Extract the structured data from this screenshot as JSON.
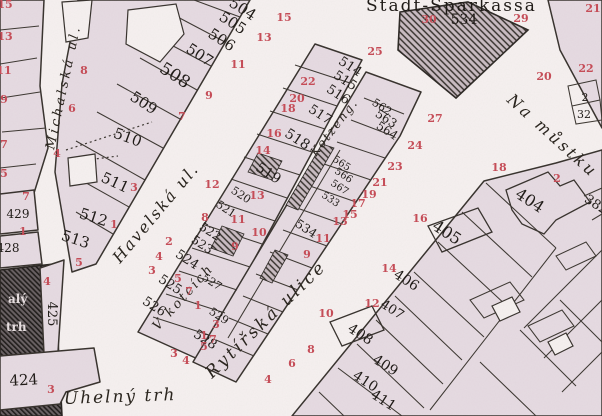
{
  "map": {
    "colors": {
      "paper": "#f6f1f0",
      "block_fill": "#e6dbe2",
      "line": "#35302b",
      "house_number_red": "#c64a55",
      "plot_number_black": "#1b1713"
    },
    "street_labels": [
      {
        "text": "Michalská ul.",
        "x": 54,
        "y": 150,
        "rot": -78,
        "size": 13,
        "ls": 3
      },
      {
        "text": "Havelská ul.",
        "x": 120,
        "y": 264,
        "rot": -50,
        "size": 16,
        "ls": 2
      },
      {
        "text": "Kotzeng.",
        "x": 316,
        "y": 157,
        "rot": -52,
        "size": 12,
        "ls": 2
      },
      {
        "text": "V kotcích",
        "x": 158,
        "y": 331,
        "rot": -48,
        "size": 13,
        "ls": 2.5
      },
      {
        "text": "Rytířská ulice",
        "x": 212,
        "y": 379,
        "rot": -44,
        "size": 17,
        "ls": 3
      },
      {
        "text": "Uhelný trh",
        "x": 64,
        "y": 404,
        "rot": -2,
        "size": 17,
        "ls": 2
      },
      {
        "text": "Na můstku",
        "x": 506,
        "y": 101,
        "rot": 42,
        "size": 16,
        "ls": 3
      }
    ],
    "building_labels": [
      {
        "text": "Stadt-Sparkassa",
        "x": 366,
        "y": 11,
        "rot": 0,
        "size": 17,
        "ls": 2
      }
    ],
    "plot_numbers": [
      {
        "text": "504",
        "x": 240,
        "y": 13,
        "rot": 33,
        "size": 15
      },
      {
        "text": "505",
        "x": 230,
        "y": 27,
        "rot": 33,
        "size": 15
      },
      {
        "text": "506",
        "x": 219,
        "y": 44,
        "rot": 33,
        "size": 15
      },
      {
        "text": "507",
        "x": 197,
        "y": 59,
        "rot": 33,
        "size": 15
      },
      {
        "text": "508",
        "x": 172,
        "y": 80,
        "rot": 33,
        "size": 17
      },
      {
        "text": "509",
        "x": 141,
        "y": 107,
        "rot": 33,
        "size": 15
      },
      {
        "text": "510",
        "x": 126,
        "y": 142,
        "rot": 20,
        "size": 15
      },
      {
        "text": "511",
        "x": 113,
        "y": 187,
        "rot": 25,
        "size": 15
      },
      {
        "text": "512",
        "x": 92,
        "y": 222,
        "rot": 18,
        "size": 15
      },
      {
        "text": "513",
        "x": 74,
        "y": 244,
        "rot": 18,
        "size": 15
      },
      {
        "text": "429",
        "x": 18,
        "y": 218,
        "rot": 0,
        "size": 12
      },
      {
        "text": "428",
        "x": 8,
        "y": 252,
        "rot": 0,
        "size": 12
      },
      {
        "text": "425",
        "x": 48,
        "y": 314,
        "rot": 90,
        "size": 13
      },
      {
        "text": "424",
        "x": 24,
        "y": 385,
        "rot": -3,
        "size": 15
      },
      {
        "text": "514",
        "x": 348,
        "y": 70,
        "rot": 33,
        "size": 13
      },
      {
        "text": "515",
        "x": 343,
        "y": 84,
        "rot": 33,
        "size": 13
      },
      {
        "text": "516",
        "x": 336,
        "y": 98,
        "rot": 33,
        "size": 13
      },
      {
        "text": "517",
        "x": 318,
        "y": 118,
        "rot": 33,
        "size": 13
      },
      {
        "text": "518",
        "x": 295,
        "y": 143,
        "rot": 33,
        "size": 14
      },
      {
        "text": "519",
        "x": 266,
        "y": 177,
        "rot": 33,
        "size": 14
      },
      {
        "text": "520",
        "x": 239,
        "y": 198,
        "rot": 33,
        "size": 11
      },
      {
        "text": "521",
        "x": 224,
        "y": 212,
        "rot": 33,
        "size": 11
      },
      {
        "text": "522",
        "x": 208,
        "y": 235,
        "rot": 33,
        "size": 12
      },
      {
        "text": "523",
        "x": 200,
        "y": 248,
        "rot": 33,
        "size": 12
      },
      {
        "text": "524",
        "x": 185,
        "y": 263,
        "rot": 33,
        "size": 13
      },
      {
        "text": "525",
        "x": 168,
        "y": 288,
        "rot": 33,
        "size": 13
      },
      {
        "text": "526",
        "x": 152,
        "y": 310,
        "rot": 33,
        "size": 13
      },
      {
        "text": "527",
        "x": 210,
        "y": 285,
        "rot": 33,
        "size": 11
      },
      {
        "text": "529",
        "x": 217,
        "y": 319,
        "rot": 33,
        "size": 11
      },
      {
        "text": "528",
        "x": 203,
        "y": 343,
        "rot": 33,
        "size": 13
      },
      {
        "text": "562",
        "x": 380,
        "y": 110,
        "rot": 33,
        "size": 11
      },
      {
        "text": "563",
        "x": 384,
        "y": 122,
        "rot": 33,
        "size": 12
      },
      {
        "text": "564",
        "x": 385,
        "y": 134,
        "rot": 33,
        "size": 12
      },
      {
        "text": "565",
        "x": 340,
        "y": 166,
        "rot": 33,
        "size": 10
      },
      {
        "text": "566",
        "x": 342,
        "y": 178,
        "rot": 33,
        "size": 10
      },
      {
        "text": "567",
        "x": 338,
        "y": 190,
        "rot": 33,
        "size": 10
      },
      {
        "text": "533",
        "x": 329,
        "y": 202,
        "rot": 33,
        "size": 10
      },
      {
        "text": "534",
        "x": 304,
        "y": 232,
        "rot": 33,
        "size": 12
      },
      {
        "text": "534",
        "x": 464,
        "y": 24,
        "rot": 0,
        "size": 14
      },
      {
        "text": "2",
        "x": 585,
        "y": 101,
        "rot": 0,
        "size": 11
      },
      {
        "text": "32",
        "x": 584,
        "y": 118,
        "rot": 0,
        "size": 11
      },
      {
        "text": "404",
        "x": 527,
        "y": 205,
        "rot": 33,
        "size": 16
      },
      {
        "text": "382",
        "x": 594,
        "y": 208,
        "rot": 33,
        "size": 13
      },
      {
        "text": "405",
        "x": 444,
        "y": 237,
        "rot": 33,
        "size": 16
      },
      {
        "text": "406",
        "x": 404,
        "y": 284,
        "rot": 33,
        "size": 14
      },
      {
        "text": "407",
        "x": 390,
        "y": 313,
        "rot": 33,
        "size": 13
      },
      {
        "text": "408",
        "x": 358,
        "y": 338,
        "rot": 33,
        "size": 14
      },
      {
        "text": "409",
        "x": 383,
        "y": 369,
        "rot": 33,
        "size": 14
      },
      {
        "text": "410",
        "x": 363,
        "y": 385,
        "rot": 33,
        "size": 14
      },
      {
        "text": "411",
        "x": 381,
        "y": 404,
        "rot": 33,
        "size": 14
      }
    ],
    "house_numbers": [
      {
        "text": "15",
        "x": 5,
        "y": 8
      },
      {
        "text": "13",
        "x": 5,
        "y": 40
      },
      {
        "text": "11",
        "x": 4,
        "y": 74
      },
      {
        "text": "9",
        "x": 4,
        "y": 103
      },
      {
        "text": "7",
        "x": 4,
        "y": 148
      },
      {
        "text": "5",
        "x": 4,
        "y": 177
      },
      {
        "text": "7",
        "x": 26,
        "y": 200
      },
      {
        "text": "1",
        "x": 23,
        "y": 235
      },
      {
        "text": "4",
        "x": 47,
        "y": 285
      },
      {
        "text": "3",
        "x": 51,
        "y": 393
      },
      {
        "text": "15",
        "x": 284,
        "y": 21
      },
      {
        "text": "13",
        "x": 264,
        "y": 41
      },
      {
        "text": "11",
        "x": 238,
        "y": 68
      },
      {
        "text": "9",
        "x": 209,
        "y": 99
      },
      {
        "text": "7",
        "x": 182,
        "y": 120
      },
      {
        "text": "3",
        "x": 134,
        "y": 191
      },
      {
        "text": "1",
        "x": 114,
        "y": 228
      },
      {
        "text": "8",
        "x": 84,
        "y": 74
      },
      {
        "text": "6",
        "x": 72,
        "y": 112
      },
      {
        "text": "4",
        "x": 57,
        "y": 157
      },
      {
        "text": "5",
        "x": 79,
        "y": 266
      },
      {
        "text": "22",
        "x": 308,
        "y": 85
      },
      {
        "text": "20",
        "x": 297,
        "y": 102
      },
      {
        "text": "18",
        "x": 288,
        "y": 112
      },
      {
        "text": "16",
        "x": 274,
        "y": 137
      },
      {
        "text": "14",
        "x": 263,
        "y": 154
      },
      {
        "text": "12",
        "x": 212,
        "y": 188
      },
      {
        "text": "13",
        "x": 257,
        "y": 199
      },
      {
        "text": "11",
        "x": 238,
        "y": 223
      },
      {
        "text": "10",
        "x": 259,
        "y": 236
      },
      {
        "text": "9",
        "x": 235,
        "y": 250
      },
      {
        "text": "8",
        "x": 205,
        "y": 221
      },
      {
        "text": "7",
        "x": 189,
        "y": 295
      },
      {
        "text": "5",
        "x": 178,
        "y": 282
      },
      {
        "text": "4",
        "x": 159,
        "y": 260
      },
      {
        "text": "3",
        "x": 152,
        "y": 274
      },
      {
        "text": "2",
        "x": 169,
        "y": 245
      },
      {
        "text": "1",
        "x": 198,
        "y": 309
      },
      {
        "text": "5",
        "x": 204,
        "y": 350
      },
      {
        "text": "7",
        "x": 213,
        "y": 343
      },
      {
        "text": "4",
        "x": 186,
        "y": 364
      },
      {
        "text": "3",
        "x": 174,
        "y": 357
      },
      {
        "text": "25",
        "x": 375,
        "y": 55
      },
      {
        "text": "27",
        "x": 435,
        "y": 122
      },
      {
        "text": "24",
        "x": 415,
        "y": 149
      },
      {
        "text": "23",
        "x": 395,
        "y": 170
      },
      {
        "text": "21",
        "x": 380,
        "y": 186
      },
      {
        "text": "19",
        "x": 369,
        "y": 198
      },
      {
        "text": "17",
        "x": 358,
        "y": 207
      },
      {
        "text": "15",
        "x": 350,
        "y": 218
      },
      {
        "text": "13",
        "x": 340,
        "y": 225
      },
      {
        "text": "11",
        "x": 323,
        "y": 242
      },
      {
        "text": "9",
        "x": 307,
        "y": 258
      },
      {
        "text": "3",
        "x": 216,
        "y": 328
      },
      {
        "text": "1",
        "x": 204,
        "y": 339
      },
      {
        "text": "30",
        "x": 429,
        "y": 23
      },
      {
        "text": "29",
        "x": 521,
        "y": 22
      },
      {
        "text": "21",
        "x": 593,
        "y": 12
      },
      {
        "text": "22",
        "x": 586,
        "y": 72
      },
      {
        "text": "20",
        "x": 544,
        "y": 80
      },
      {
        "text": "2",
        "x": 557,
        "y": 182
      },
      {
        "text": "18",
        "x": 499,
        "y": 171
      },
      {
        "text": "16",
        "x": 420,
        "y": 222
      },
      {
        "text": "14",
        "x": 389,
        "y": 272
      },
      {
        "text": "12",
        "x": 372,
        "y": 307
      },
      {
        "text": "10",
        "x": 326,
        "y": 317
      },
      {
        "text": "8",
        "x": 311,
        "y": 353
      },
      {
        "text": "6",
        "x": 292,
        "y": 367
      },
      {
        "text": "4",
        "x": 268,
        "y": 383
      }
    ],
    "fragments": [
      {
        "text": "alý",
        "x": 8,
        "y": 303,
        "rot": 0,
        "size": 12
      },
      {
        "text": "trh",
        "x": 6,
        "y": 331,
        "rot": 0,
        "size": 12
      }
    ]
  }
}
